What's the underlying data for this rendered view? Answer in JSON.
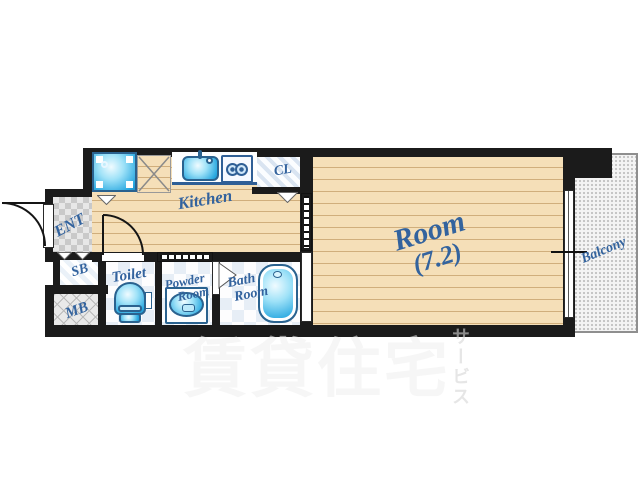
{
  "rooms": {
    "kitchen": {
      "label": "Kitchen"
    },
    "room": {
      "label": "Room",
      "size": "(7.2)"
    },
    "balcony": {
      "label": "Balcony"
    },
    "entrance": {
      "label": "ENT"
    },
    "shoe_box": {
      "label": "SB"
    },
    "meter_box": {
      "label": "MB"
    },
    "toilet": {
      "label": "Toilet"
    },
    "powder_room": {
      "line1": "Powder",
      "line2": "Room"
    },
    "bath_room": {
      "line1": "Bath",
      "line2": "Room"
    },
    "closet": {
      "label": "CL"
    }
  },
  "watermark": {
    "main": "賃貸住宅",
    "vertical": "サービス"
  },
  "colors": {
    "label_blue": "#33639E",
    "wall_black": "#1B1B1B",
    "wood_floor": "#F5DFB8",
    "fixture_blue": "#29A8E0",
    "balcony_gray": "#F4F4F4"
  }
}
